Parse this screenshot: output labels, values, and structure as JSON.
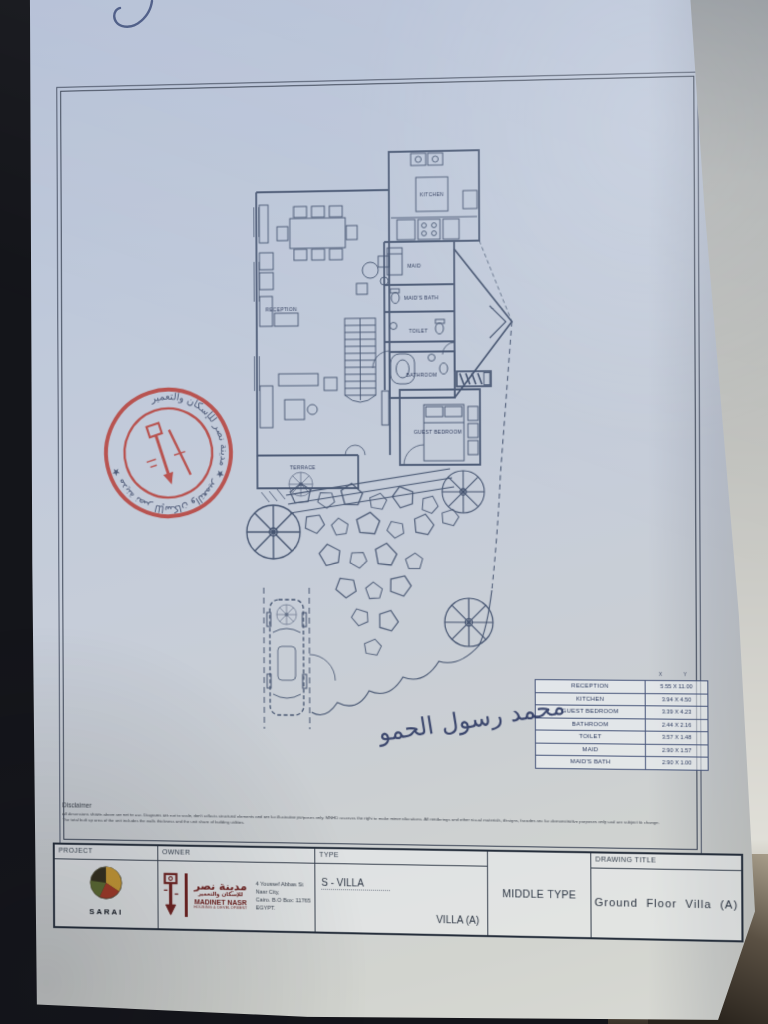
{
  "photo": {
    "handwritten_mark": "5",
    "signature_text": "محمد رسول الحمو"
  },
  "plan": {
    "rooms": [
      {
        "label": "KITCHEN"
      },
      {
        "label": "RECEPTION"
      },
      {
        "label": "MAID"
      },
      {
        "label": "MAID'S BATH"
      },
      {
        "label": "TOILET"
      },
      {
        "label": "BATHROOM"
      },
      {
        "label": "GUEST BEDROOM"
      },
      {
        "label": "TERRACE"
      }
    ],
    "stamp": {
      "ring_text": "مدينة نصر للإسكان والتعمير ★ مدينة نصر للإسكان والتعمير ★",
      "color": "#b5342c"
    }
  },
  "dim_table": {
    "col_headers": [
      "X",
      "Y"
    ],
    "rows": [
      {
        "room": "RECEPTION",
        "dim": "5.55 X 11.00"
      },
      {
        "room": "KITCHEN",
        "dim": "3.94 X 4.50"
      },
      {
        "room": "GUEST BEDROOM",
        "dim": "3.39 X 4.23"
      },
      {
        "room": "BATHROOM",
        "dim": "2.44 X 2.16"
      },
      {
        "room": "TOILET",
        "dim": "3.57 X 1.48"
      },
      {
        "room": "MAID",
        "dim": "2.90 X 1.57"
      },
      {
        "room": "MAID'S BATH",
        "dim": "2.90 X 1.00"
      }
    ]
  },
  "disclaimer": {
    "title": "Disclaimer",
    "line1": "All dimensions shown above are net to use. Diagrams are not to scale, don't reflects structural elements and are for illustrative purposes only. MNHD reserves the right to make minor alterations. All renderings and other visual materials, designs, facades are for demonstrative purposes only and are subject to change.",
    "line2": "The total built up area of the unit includes the walls thickness and the unit share of building utilities."
  },
  "title_block": {
    "project_label": "PROJECT",
    "owner_label": "OWNER",
    "type_label": "TYPE",
    "drawing_title_label": "DRAWING TITLE",
    "project_name": "SARAI",
    "owner": {
      "arabic_name": "مدينة نصر",
      "arabic_sub": "للإسكان والتعمير",
      "latin_name": "MADINET NASR",
      "latin_sub": "HOUSING & DEVELOPMENT",
      "address_line1": "4 Youssef Abbas St",
      "address_line2": "Nasr City,",
      "address_line3": "Cairo. B.O Box: 11765",
      "address_line4": "EGYPT."
    },
    "type_value_1": "S - VILLA",
    "type_value_2": "VILLA (A)",
    "middle_type": "MIDDLE TYPE",
    "drawing_title": "Ground Floor Villa (A)"
  },
  "colors": {
    "paper": "#c3cbd9",
    "ink": "#44536f",
    "stamp_red": "#b5342c",
    "logo_maroon": "#6e2220",
    "sarai_gold": "#c79a35"
  }
}
